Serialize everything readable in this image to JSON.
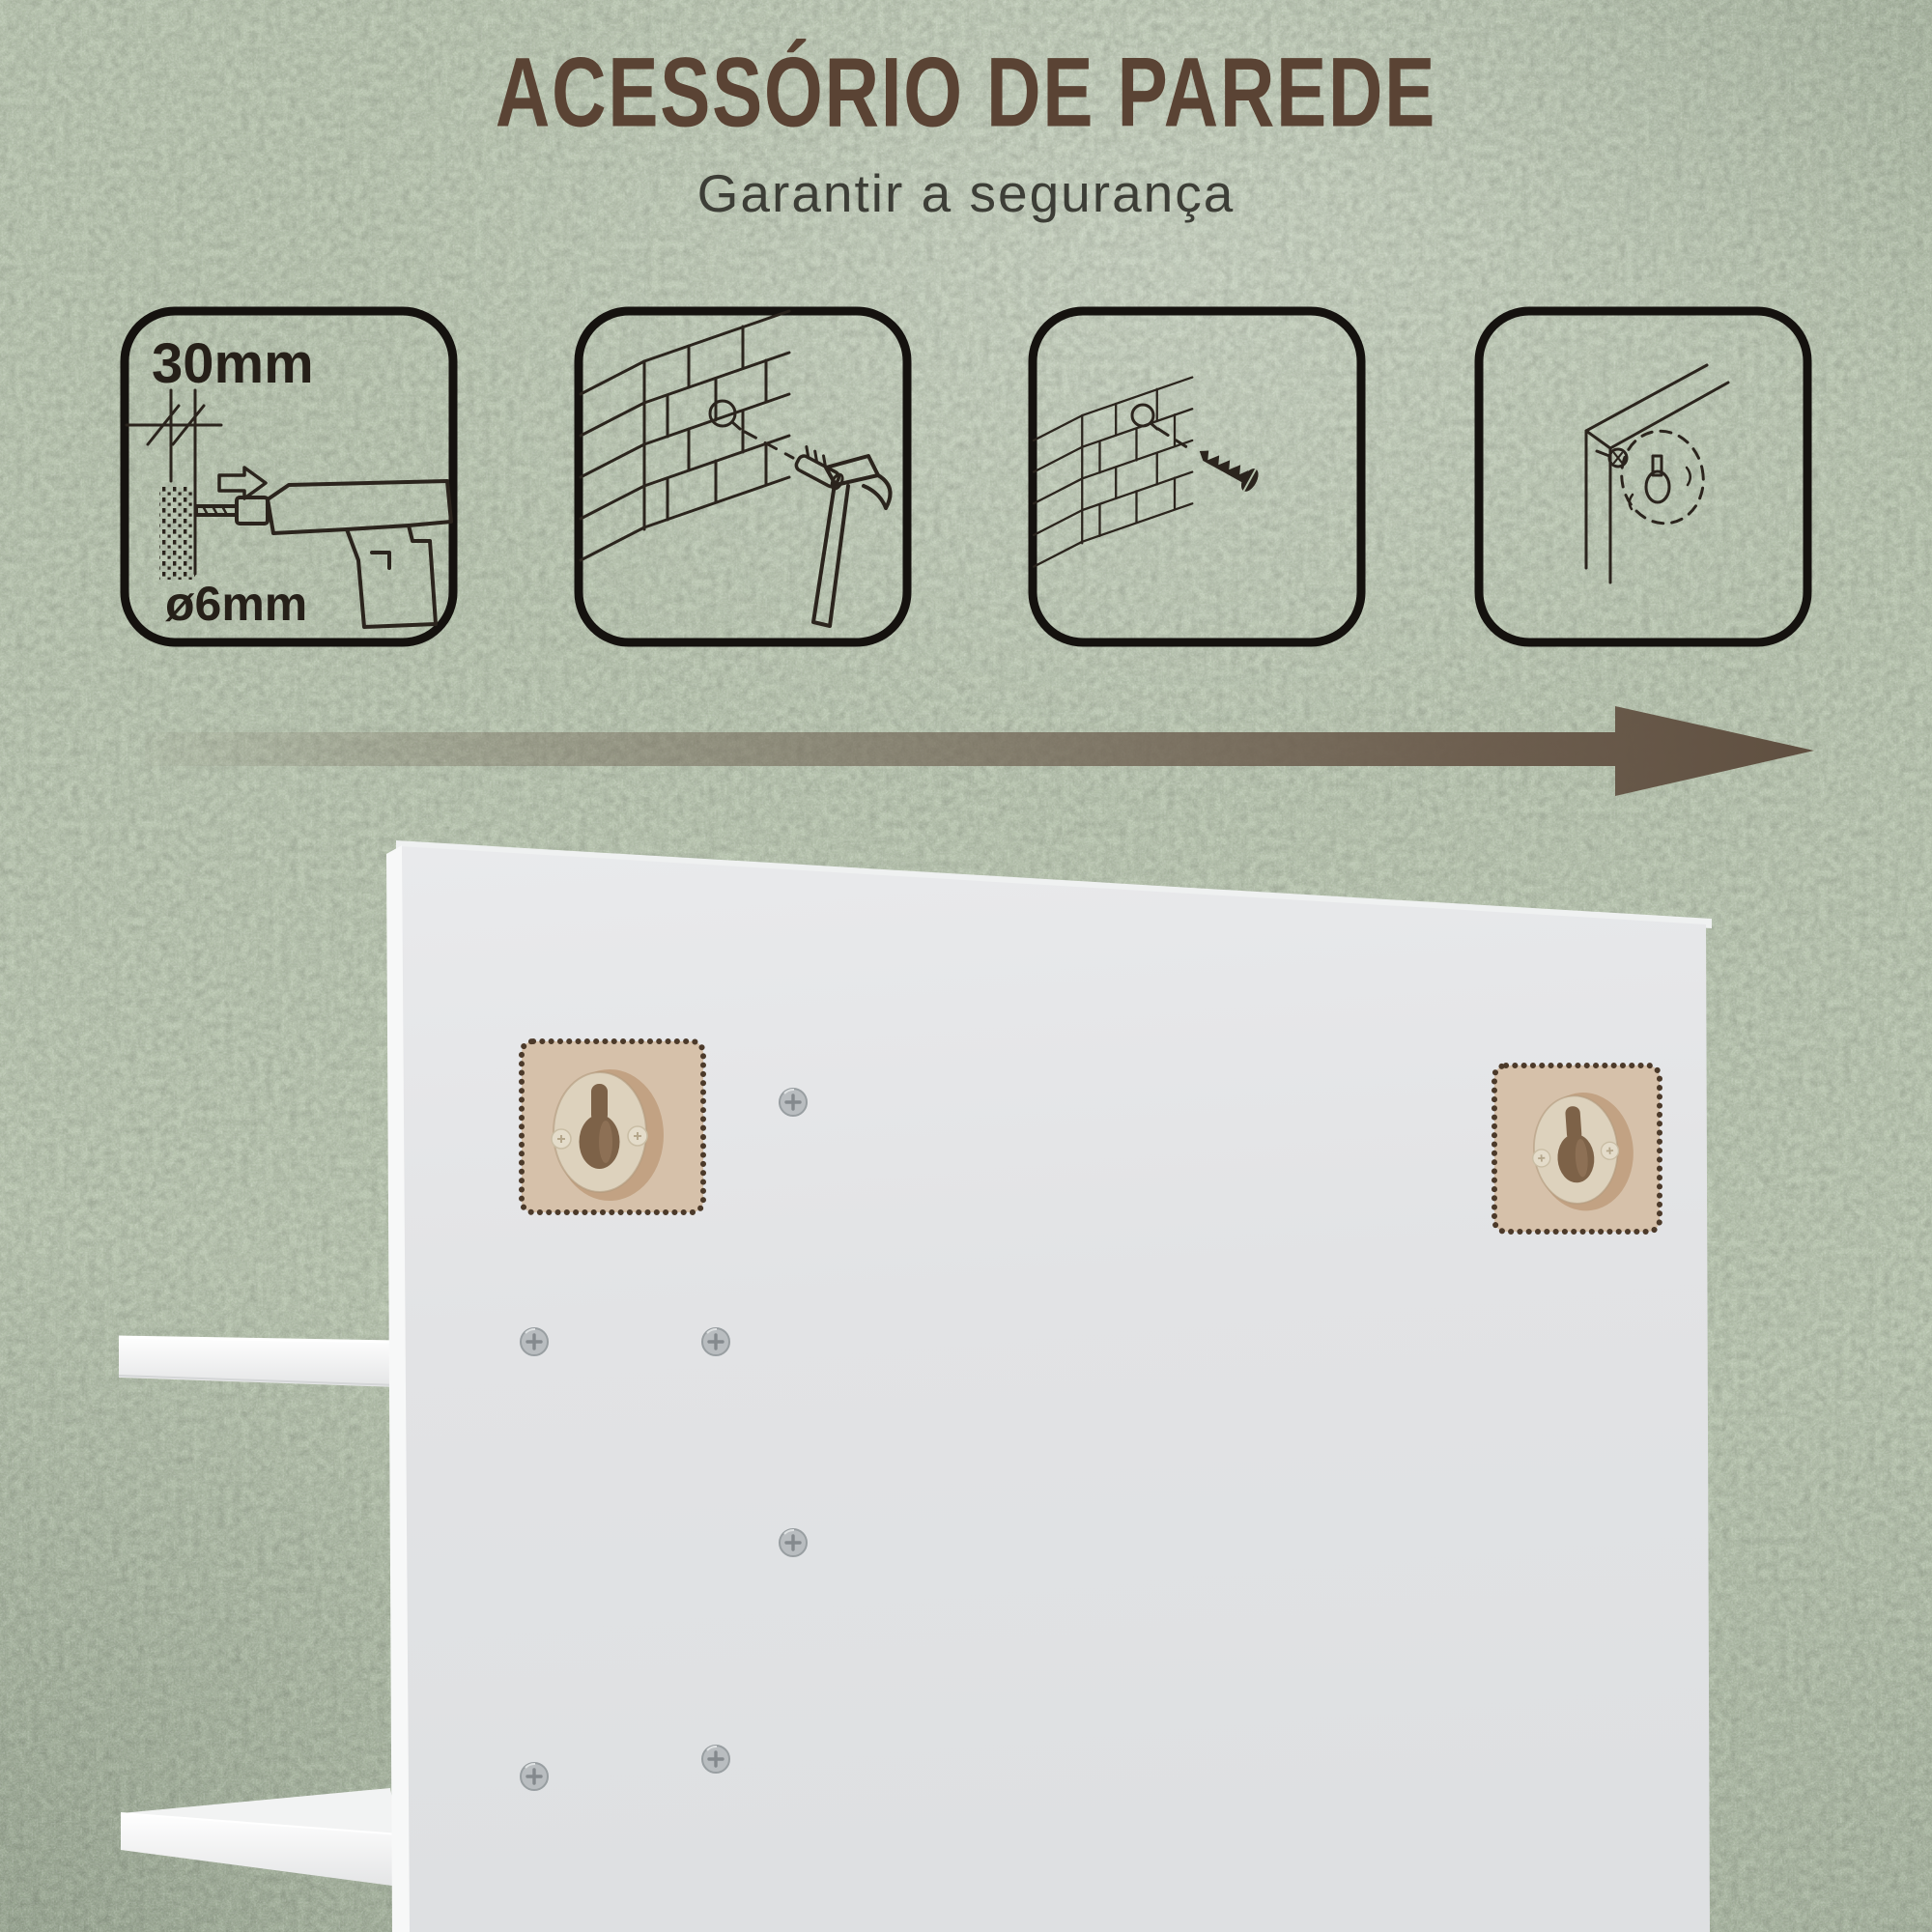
{
  "header": {
    "title": "ACESSÓRIO DE PAREDE",
    "subtitle": "Garantir a segurança"
  },
  "steps": [
    {
      "name": "drill-hole",
      "icon": "drill-icon",
      "depth_label": "30mm",
      "diameter_label": "ø6mm"
    },
    {
      "name": "insert-wall-plug",
      "icon": "wall-plug-hammer-icon"
    },
    {
      "name": "drive-screw",
      "icon": "wall-screw-icon"
    },
    {
      "name": "hang-panel-on-screw",
      "icon": "keyhole-hanger-icon"
    }
  ],
  "flow": {
    "icon": "right-arrow-icon",
    "direction": "right",
    "color": "#6d5f50"
  },
  "scene": {
    "name": "cabinet-back-panel",
    "keyhole_mounts": 2,
    "screws": 6,
    "shelves": 2,
    "colors": {
      "wall": "#b5c2ac",
      "panel_face": "#e2e3e5",
      "panel_edge": "#f7f8f8",
      "highlight_square": "#d6c1aa",
      "highlight_dots": "#4c3a2a",
      "hanger_ring": "#ddd2bd",
      "hanger_hole": "#7d6248",
      "title_brown": "#5a4334",
      "arrow_brown": "#6d5f50"
    }
  }
}
